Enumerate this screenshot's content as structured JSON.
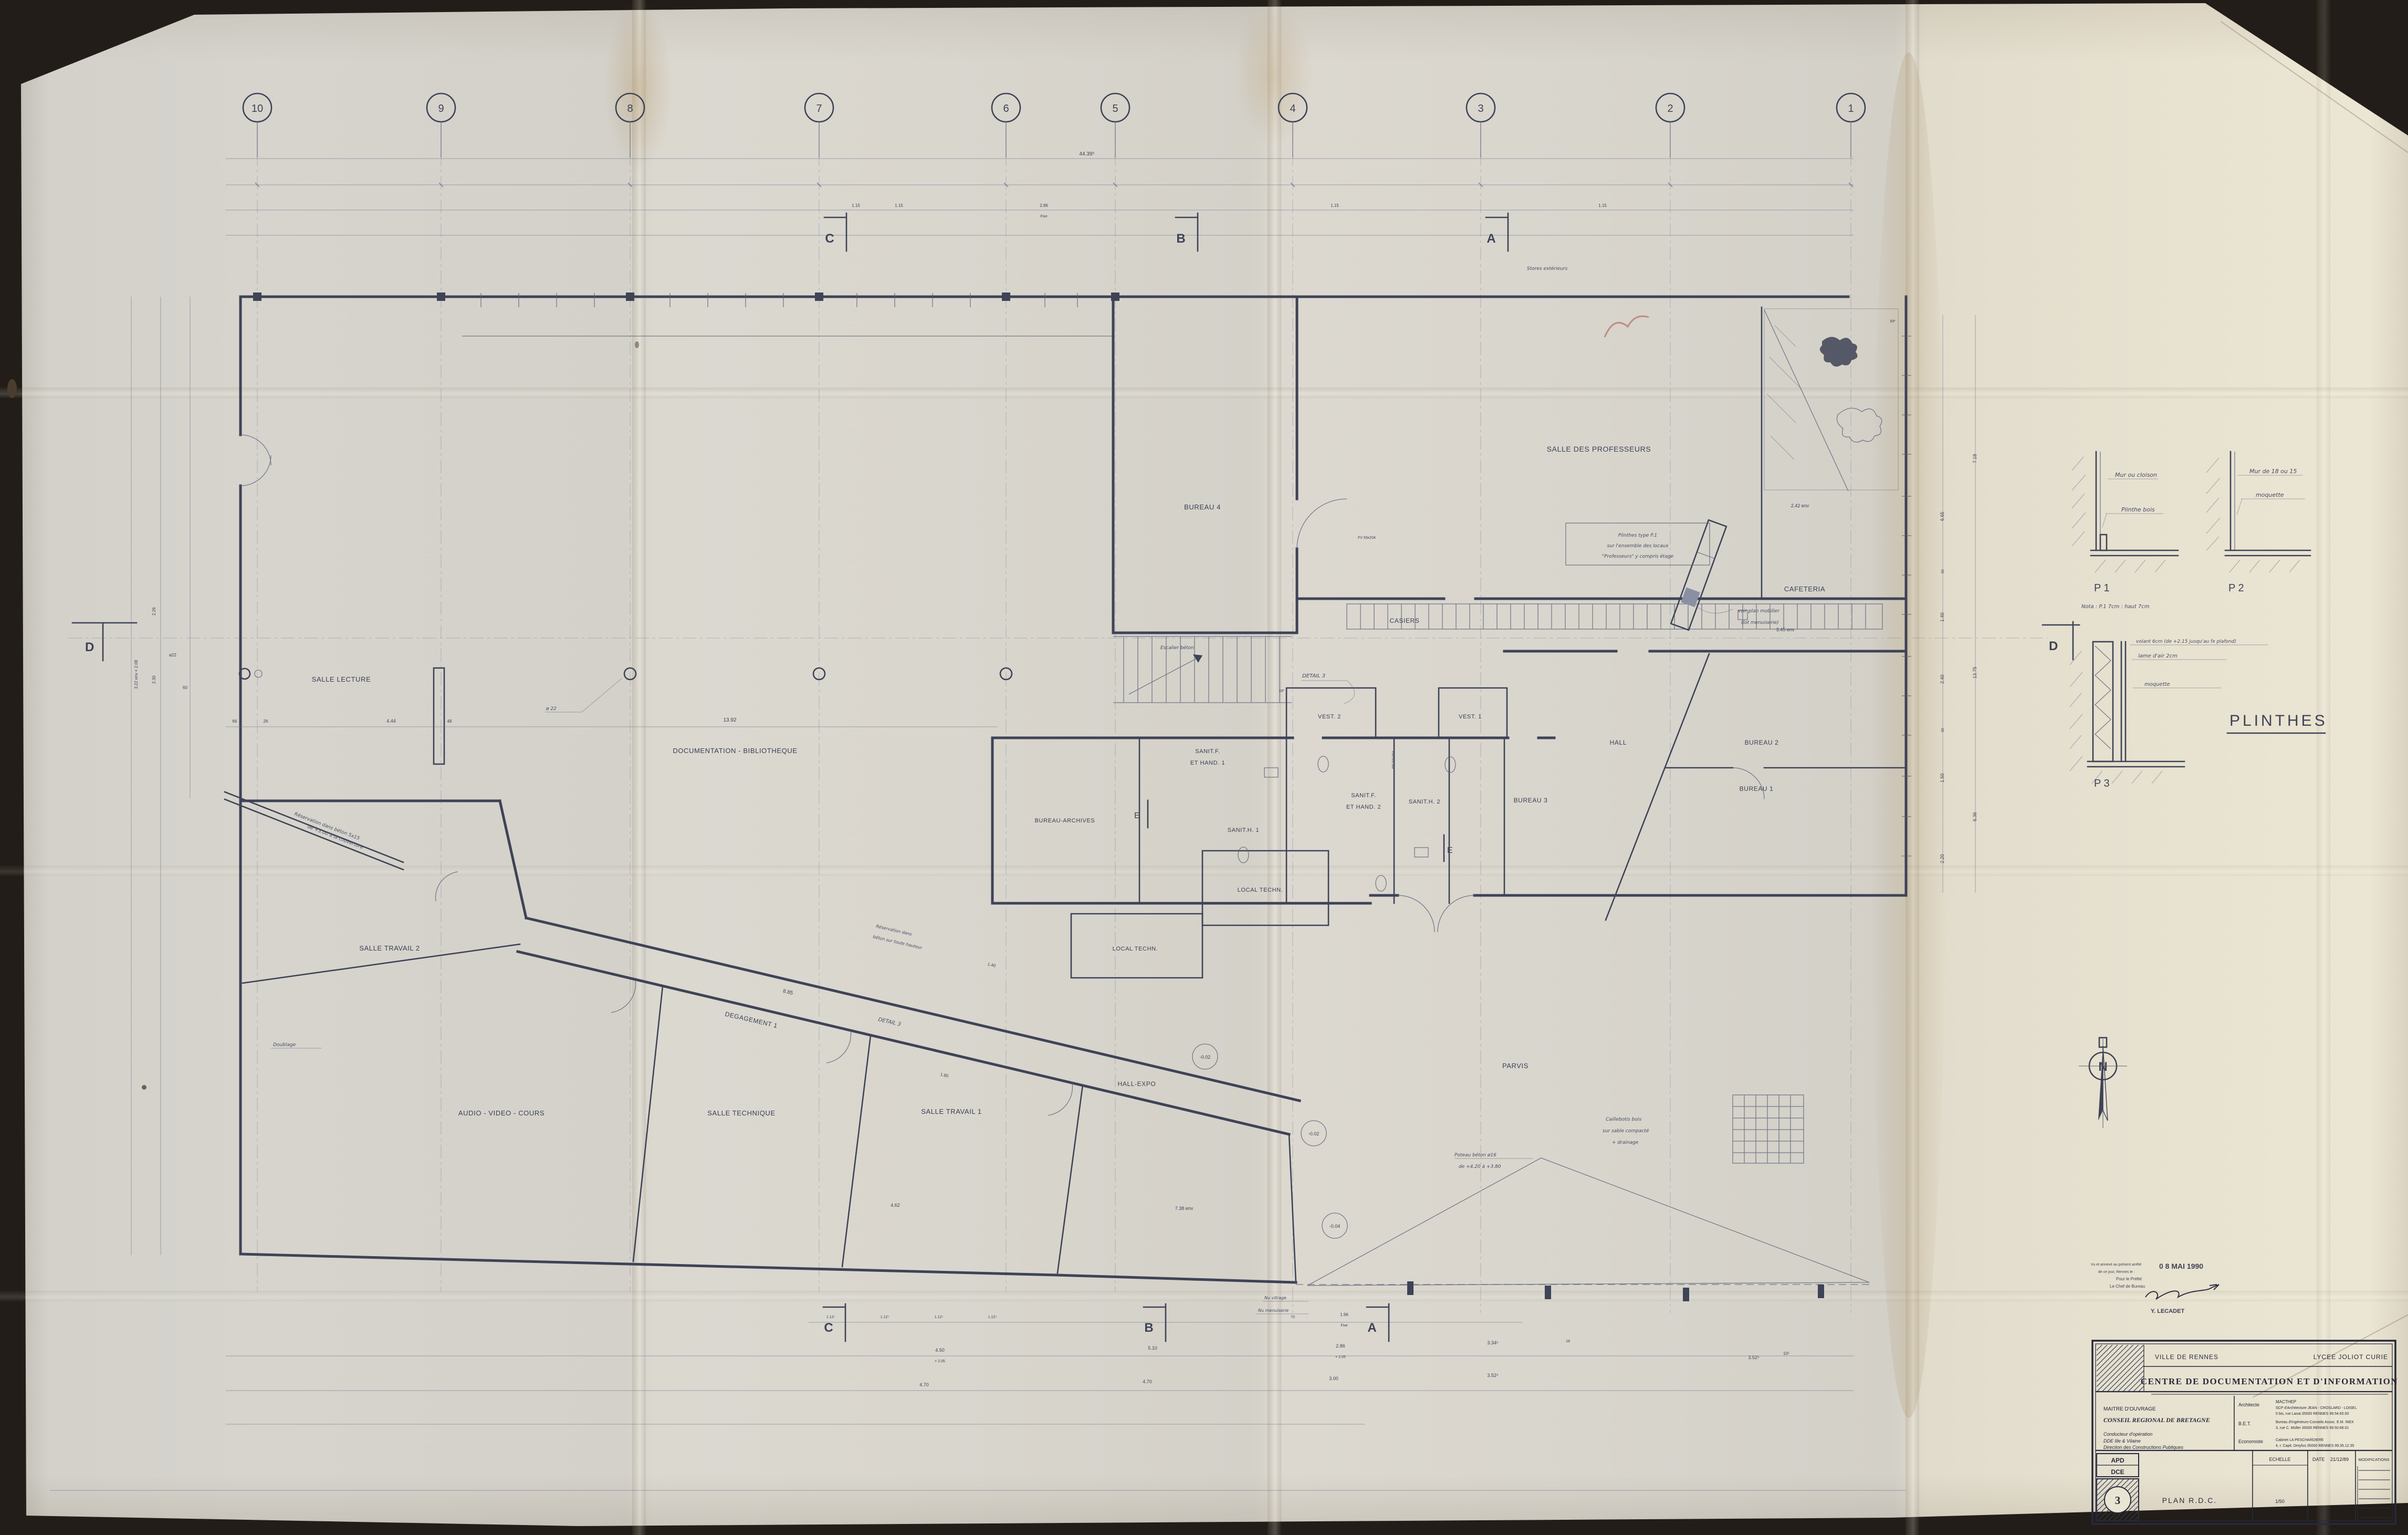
{
  "plan": {
    "grid_bubbles": [
      "10",
      "9",
      "8",
      "7",
      "6",
      "5",
      "4",
      "3",
      "2",
      "1"
    ],
    "axis_letters": {
      "c": "C",
      "b": "B",
      "a": "A",
      "d": "D",
      "e": "E"
    },
    "rooms": {
      "salle_lecture": "SALLE LECTURE",
      "documentation": "DOCUMENTATION - BIBLIOTHEQUE",
      "bureau4": "BUREAU 4",
      "salle_profs": "SALLE DES PROFESSEURS",
      "cafeteria": "CAFETERIA",
      "casiers": "CASIERS",
      "escalier": "Escalier béton",
      "vest2": "VEST. 2",
      "vest1": "VEST. 1",
      "sanitf1a": "SANIT.F.",
      "sanitf1b": "ET HAND. 1",
      "sanith1": "SANIT.H. 1",
      "sanitf2a": "SANIT.F.",
      "sanitf2b": "ET HAND. 2",
      "sanith2": "SANIT.H. 2",
      "bureau3": "BUREAU 3",
      "hall": "HALL",
      "bureau2": "BUREAU 2",
      "bureau1": "BUREAU 1",
      "bureau_archives": "BUREAU-ARCHIVES",
      "local_techn1": "LOCAL TECHN.",
      "local_techn2": "LOCAL TECHN.",
      "salle_travail2": "SALLE TRAVAIL 2",
      "degagement1": "DEGAGEMENT 1",
      "audio_video": "AUDIO - VIDEO - COURS",
      "salle_technique": "SALLE TECHNIQUE",
      "salle_travail1": "SALLE TRAVAIL 1",
      "hall_expo": "HALL-EXPO",
      "parvis": "PARVIS"
    },
    "notes": {
      "plinthes1": "Plinthes type P.1",
      "plinthes2": "sur l'ensemble des locaux",
      "plinthes3": "\"Professeurs\" y compris étage",
      "mobilier1": "voir plan mobilier",
      "mobilier2": "(lot menuiserie)",
      "stores": "Stores extérieurs",
      "caillebotis1": "Caillebotis bois",
      "caillebotis2": "sur sable compacté",
      "caillebotis3": "+ drainage",
      "poteau1": "Poteau béton ø16",
      "poteau2": "de +4.20 à +3.80",
      "reservation1": "Réservation dans",
      "reservation2": "béton sur toute hauteur",
      "reservation3": "Réservation dans béton 5x15",
      "reservation4": "de +3.00 à la couverture",
      "doublage": "Doublage",
      "detail3": "DETAIL 3",
      "nu_vitrage": "Nu vitrage",
      "nu_menuiserie": "Nu menuiserie",
      "phi22": "ø 22",
      "ep": "EP",
      "fv": "FV 93x204",
      "pp": "PP 93x204"
    },
    "levels": {
      "m002": "-0.02",
      "m004": "-0.04"
    },
    "dims": {
      "total": "44.39⁵",
      "lib_width": "13.92",
      "d444": "4.44",
      "d48": "48",
      "d66": "66",
      "d26": "26",
      "d885": "8.85",
      "d140": "1.40",
      "d180": "1.80",
      "d242": "2.42 env",
      "d345": "3.45 env",
      "d738": "7.38 env",
      "d462": "4.62",
      "d115": "1.15",
      "d286": "2.86",
      "fixe": "Fixe",
      "d112": "1.12⁵",
      "d450": "4.50",
      "x205": "× 2.05",
      "d510": "5.10",
      "d334": "3.34⁵",
      "d470": "4.70",
      "d300": "3.00",
      "d352": "3.52⁵",
      "d18": "18",
      "d70": "70",
      "d196": "1.96",
      "d105": "10⁵",
      "d665": "6.65",
      "d1375": "13.75",
      "d636": "6.36",
      "d240": "2.40",
      "d150": "1.50",
      "d220": "2.20",
      "d90": "90",
      "d718": "7.18",
      "d322": "3.22 env × 2.08",
      "d226": "2.26",
      "d230": "2.30",
      "d60": "60",
      "phi22s": "ø22"
    },
    "details": {
      "p1_label": "P 1",
      "p1_wall": "Mur ou cloison",
      "p1_plinth": "Plinthe bois",
      "p1_nota": "Nota : P.1 7cm : haut 7cm",
      "p2_label": "P 2",
      "p2_wall": "Mur de 18 ou 15",
      "p2_floor": "moquette",
      "p3_label": "P 3",
      "p3_l1": "volant 6cm (de +2.15 jusqu'au fx plafond)",
      "p3_l2": "lame d'air 2cm",
      "p3_l3": "moquette",
      "title": "PLINTHES"
    },
    "north": "N",
    "stamp": {
      "l1": "Vu et annexé au présent arrêté",
      "l2": "de ce jour, Rennes le :",
      "l3": "Pour le Préfet",
      "l4": "Le Chef de Bureau",
      "date": "0 8 MAI 1990",
      "sig": "Y. LECADET"
    },
    "titleblock": {
      "city": "VILLE DE RENNES",
      "school": "LYCEE  JOLIOT  CURIE",
      "title": "CENTRE  DE  DOCUMENTATION  ET  D'INFORMATION",
      "owner_label": "MAITRE D'OUVRAGE",
      "owner": "CONSEIL REGIONAL DE BRETAGNE",
      "cond_label": "Conducteur d'opération",
      "cond1": "DDE Ille & Vilaine",
      "cond2": "Direction des Constructions Publiques",
      "arch_label": "Architecte",
      "arch1": "MACTHEP",
      "arch2": "SCP d'Architecture JEAN - CROSLARD - LOISEL",
      "arch3": "5 bis, rue Lanai   35000 RENNES   99.54.65.00",
      "bet_label": "B.E.T.",
      "bet1": "Bureau d'Ingénieurs-Conseils Assoc. E.M. INEX",
      "bet2": "3, rue C. Müller   35000 RENNES   99.50.68.01",
      "econ_label": "Economiste",
      "econ1": "Cabinet LA PESCHARDIERE",
      "econ2": "4, r. Capit. Dreyfus   35000 RENNES   99.35.12.35",
      "phase1": "APD",
      "phase2": "DCE",
      "sheet": "3",
      "plan_name": "PLAN  R.D.C.",
      "scale_label": "ECHELLE",
      "scale_value": "1/50",
      "date_label": "DATE",
      "date_value": "21/12/89",
      "modif_label": "MODIFICATIONS"
    }
  }
}
